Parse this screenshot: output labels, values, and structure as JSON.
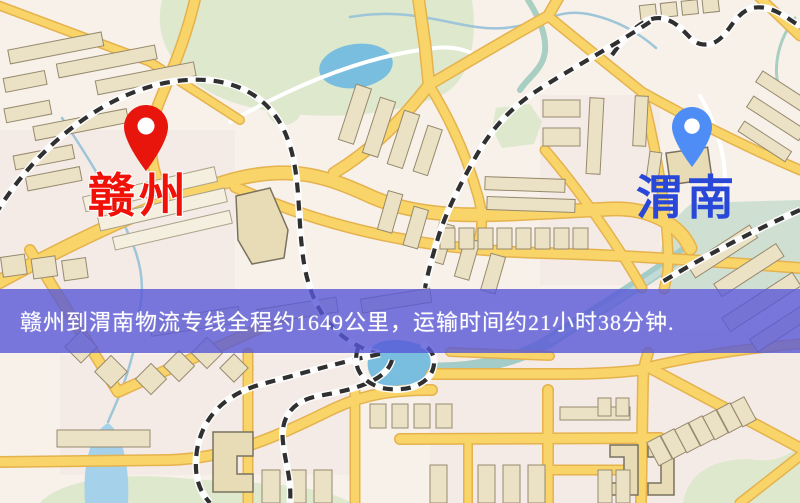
{
  "map": {
    "type": "city-road-map",
    "palette": {
      "background": "#f7f1ea",
      "road_fill": "#f8d469",
      "road_edge": "#e5b24e",
      "building": "#ebe2c6",
      "building_outline": "#97896d",
      "park_green": "#dde8cd",
      "water_blue": "#79bedf",
      "railway_dash": "#303030"
    }
  },
  "pins": [
    {
      "id": "ganzhou",
      "label": "赣州",
      "pin_color": "#e8150c",
      "label_color": "#f01208",
      "side": "left"
    },
    {
      "id": "weinan",
      "label": "渭南",
      "pin_color": "#4d8df5",
      "label_color": "#2948d8",
      "side": "right"
    }
  ],
  "banner": {
    "text": "赣州到渭南物流专线全程约1649公里，运输时间约21小时38分钟.",
    "background": "#5858d7",
    "text_color": "#ffffff",
    "distance_km": "1649",
    "duration": "21小时38分钟"
  }
}
